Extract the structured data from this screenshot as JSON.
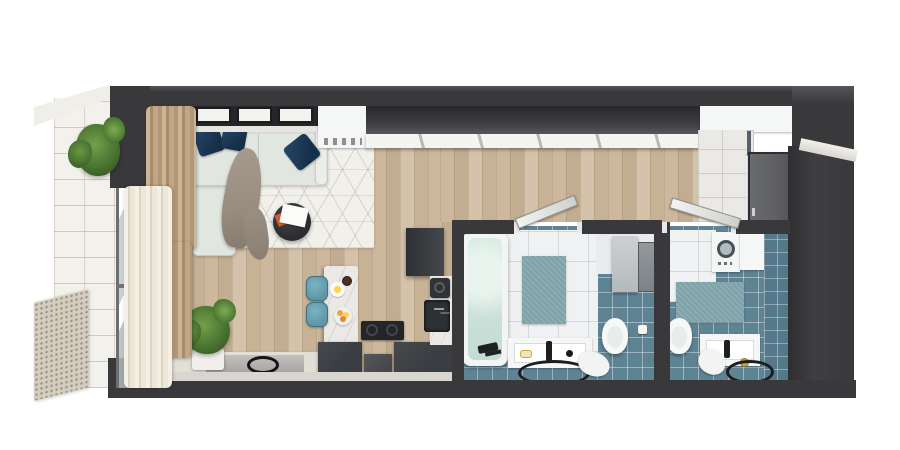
{
  "scene": {
    "type": "3d-apartment-floor-plan-render",
    "view": "top-down",
    "rooms": [
      {
        "name": "balcony",
        "items": [
          "potted-plant",
          "perforated-glass-railing",
          "white-tile-floor",
          "sliding-glass-door"
        ]
      },
      {
        "name": "living-room",
        "items": [
          "windows",
          "sofa",
          "navy-pillows",
          "throw-blanket",
          "geometric-rug",
          "round-coffee-table",
          "magazines",
          "beige-curtain",
          "sheer-curtain",
          "floor-plant",
          "media-sideboard",
          "flat-tv-panel"
        ]
      },
      {
        "name": "kitchen",
        "items": [
          "marble-island",
          "bar-stools",
          "breakfast-plate",
          "coffee-cup",
          "fruit-bowl",
          "cooktop",
          "dark-base-cabinets",
          "tall-cabinet",
          "wall-counter",
          "coffee-machine",
          "sink"
        ]
      },
      {
        "name": "hallway",
        "items": [
          "dark-wardrobe",
          "white-sliding-doors",
          "wood-floor"
        ]
      },
      {
        "name": "entry",
        "items": [
          "open-shelf",
          "books",
          "entry-door",
          "white-tile-floor"
        ]
      },
      {
        "name": "bathroom-1",
        "items": [
          "bathtub",
          "bath-faucet",
          "teal-rug",
          "vanity-sink",
          "round-floor-mat",
          "toilet",
          "wall-cabinet",
          "paper-holder",
          "towel",
          "blue-tile-floor",
          "open-door"
        ]
      },
      {
        "name": "bathroom-2",
        "items": [
          "washing-machine",
          "storage-cabinet",
          "teal-rug",
          "vanity-sink",
          "round-mirror",
          "toilet",
          "towel",
          "blue-tile-floor",
          "open-door"
        ]
      }
    ],
    "counts": {
      "navy_pillows": 3,
      "bar_stools": 2,
      "bathrooms": 2,
      "windows_panes": 4
    }
  },
  "colors": {
    "wall": "#39393b",
    "wallHi": "#55555a",
    "wood1": "#cdb89e",
    "wood2": "#c2ad91",
    "wood3": "#d4c2aa",
    "wood4": "#c7b296",
    "rugBase": "#f2f0ea",
    "sofa": "#e2e6e0",
    "pillow": "#16304a",
    "blanket": "#998c80",
    "curtainBeige": "#c2a684",
    "curtainSheer": "#ede7d9",
    "balconyTile": "#f3f1ec",
    "railing": "#d4cdbf",
    "glass": "#c0cbcc",
    "marble": "#ebe9e6",
    "kitchenDark": "#3a3d41",
    "cooktop": "#232527",
    "stool": "#5e98a8",
    "tileBlue": "#5e8494",
    "tileBlueDeep": "#54798b",
    "tileWhite": "#eff1f2",
    "bathRug": "#7fa2aa",
    "water": "#d5e8e1",
    "fixtureWhite": "#f5f6f6",
    "doorLeaf": "#5d5e62",
    "entryTile": "#eae9e6",
    "plantGreen": "#4c7a33",
    "fruitOrange": "#f0a23a",
    "fruitYellow": "#ffd24a",
    "magazineOrange": "#d85f2b"
  }
}
